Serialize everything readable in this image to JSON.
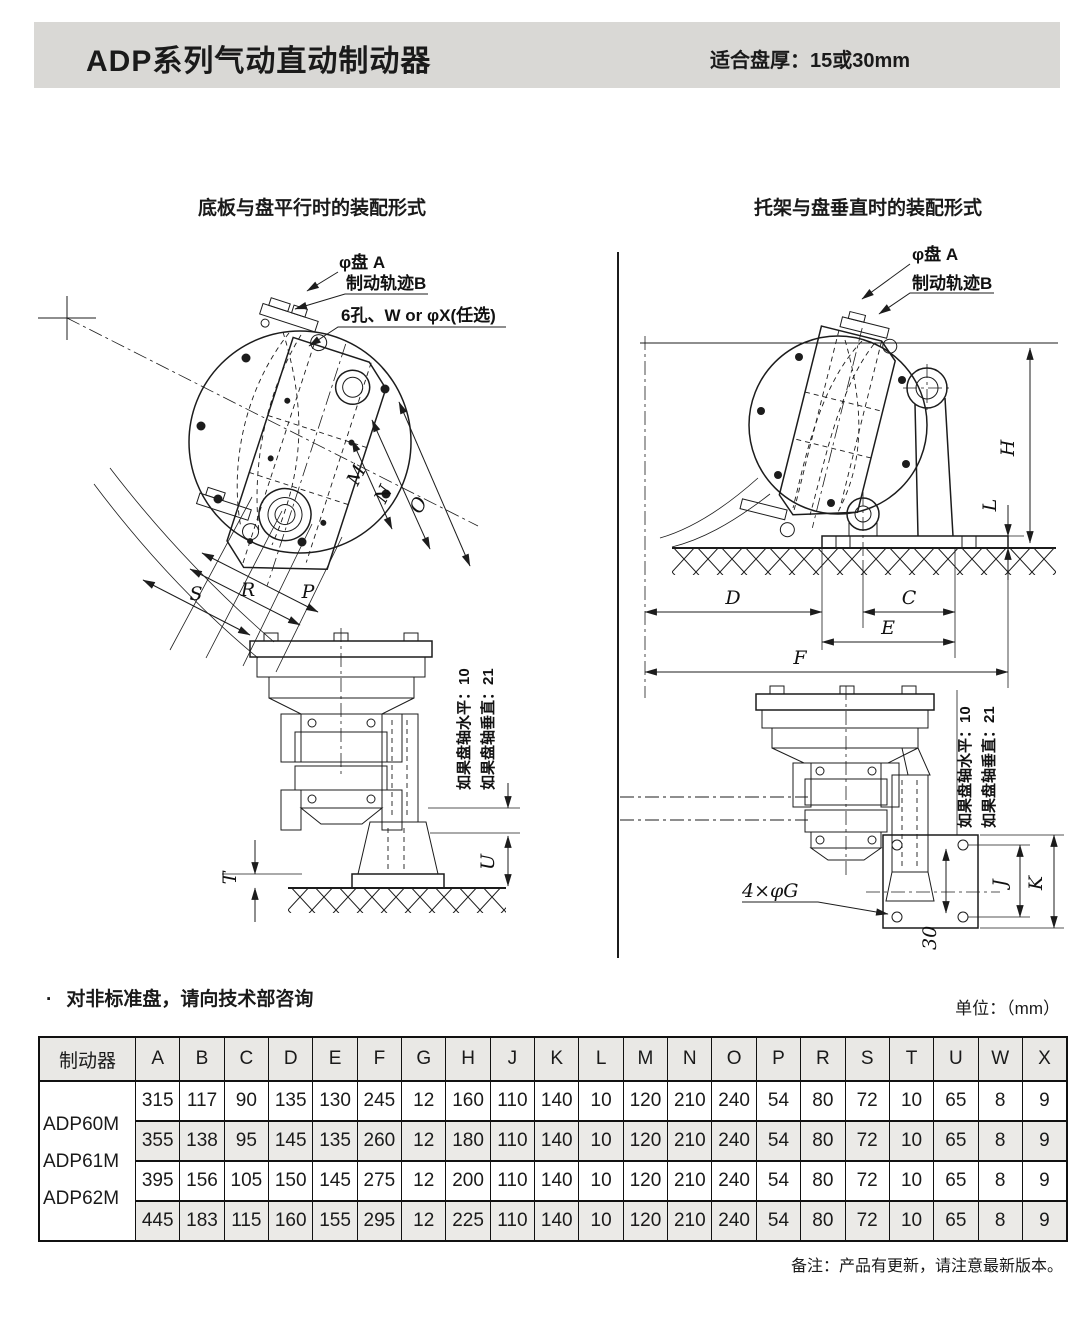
{
  "header": {
    "title": "ADP系列气动直动制动器",
    "spec_label": "适合盘厚：",
    "spec_value": "15或30mm"
  },
  "diagrams": {
    "left": {
      "title": "底板与盘平行时的装配形式",
      "callouts": {
        "disc": "φ盘 A",
        "track": "制动轨迹B",
        "holes": "6孔、W or φX(任选)"
      },
      "dims": {
        "M": "M",
        "N": "N",
        "O": "O",
        "S": "S",
        "R": "R",
        "P": "P",
        "T": "T",
        "U": "U"
      },
      "notes": {
        "horizontal": "如果盘轴水平：10",
        "vertical": "如果盘轴垂直：21"
      }
    },
    "right": {
      "title": "托架与盘垂直时的装配形式",
      "callouts": {
        "disc": "φ盘 A",
        "track": "制动轨迹B",
        "holes": "4×φG",
        "offset": "30"
      },
      "dims": {
        "H": "H",
        "L": "L",
        "D": "D",
        "C": "C",
        "E": "E",
        "F": "F",
        "J": "J",
        "K": "K"
      },
      "notes": {
        "horizontal": "如果盘轴水平：10",
        "vertical": "如果盘轴垂直：21"
      }
    }
  },
  "remark": {
    "bullet": "·",
    "text": "对非标准盘，请向技术部咨询",
    "unit": "单位：（mm）"
  },
  "table": {
    "header": [
      "制动器",
      "A",
      "B",
      "C",
      "D",
      "E",
      "F",
      "G",
      "H",
      "J",
      "K",
      "L",
      "M",
      "N",
      "O",
      "P",
      "R",
      "S",
      "T",
      "U",
      "W",
      "X"
    ],
    "models": [
      "ADP60M",
      "ADP61M",
      "ADP62M"
    ],
    "rows": [
      [
        315,
        117,
        90,
        135,
        130,
        245,
        12,
        160,
        110,
        140,
        10,
        120,
        210,
        240,
        54,
        80,
        72,
        10,
        65,
        8,
        9
      ],
      [
        355,
        138,
        95,
        145,
        135,
        260,
        12,
        180,
        110,
        140,
        10,
        120,
        210,
        240,
        54,
        80,
        72,
        10,
        65,
        8,
        9
      ],
      [
        395,
        156,
        105,
        150,
        145,
        275,
        12,
        200,
        110,
        140,
        10,
        120,
        210,
        240,
        54,
        80,
        72,
        10,
        65,
        8,
        9
      ],
      [
        445,
        183,
        115,
        160,
        155,
        295,
        12,
        225,
        110,
        140,
        10,
        120,
        210,
        240,
        54,
        80,
        72,
        10,
        65,
        8,
        9
      ]
    ]
  },
  "footer": {
    "note": "备注：产品有更新，请注意最新版本。"
  }
}
